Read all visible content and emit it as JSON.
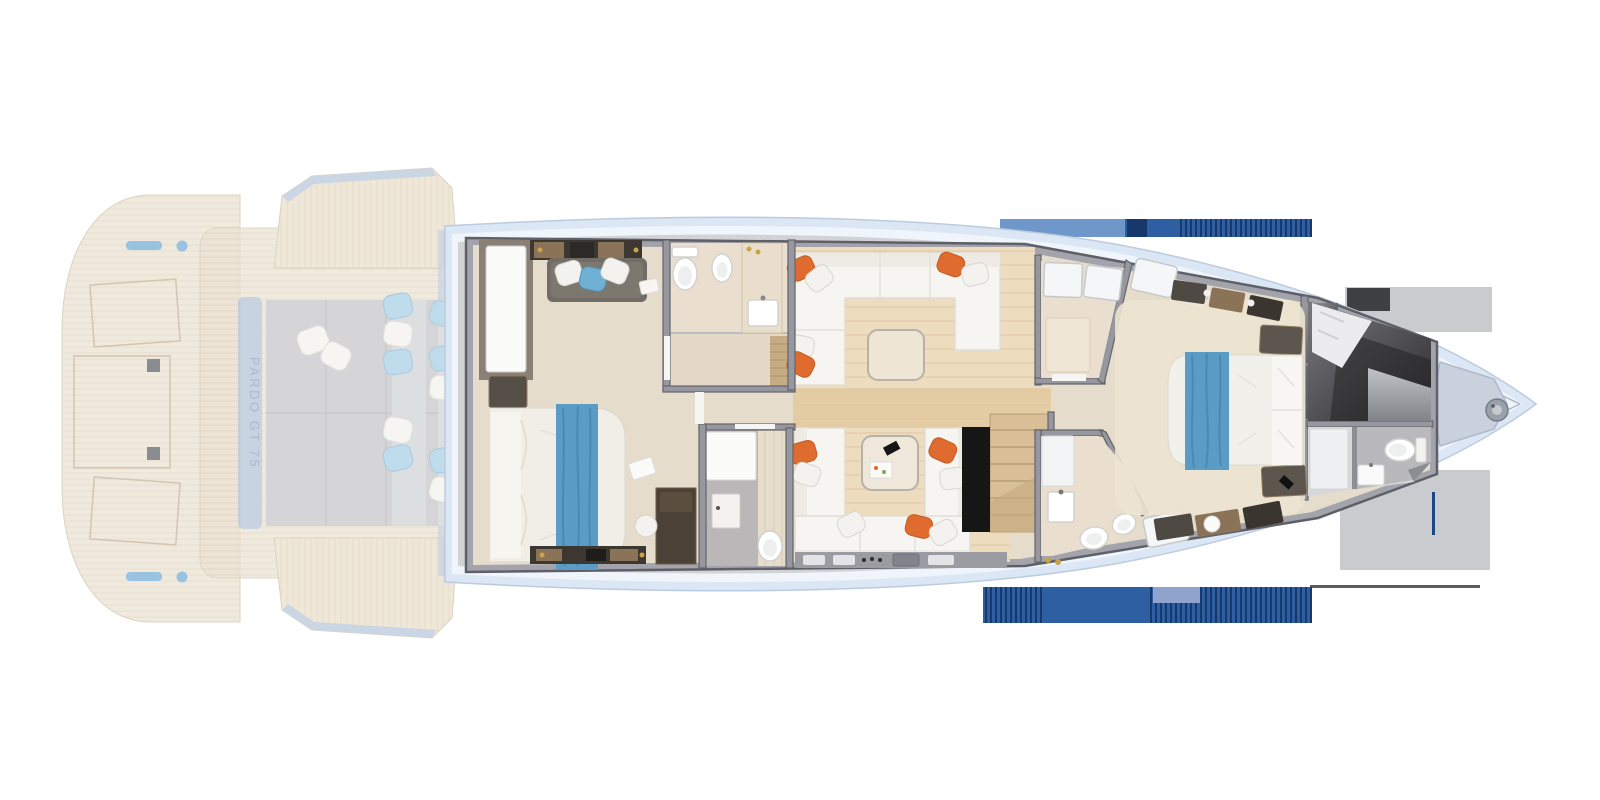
{
  "branding": {
    "model_label": "PARDO GT 75"
  },
  "palette": {
    "page_bg": "#ffffff",
    "teak": "#ede5d6",
    "teak_line": "#d8c9ae",
    "hull_band": "#dce7f5",
    "hull_band_inner": "#f0f5fc",
    "deck_gray": "#d2d3d7",
    "wall_gray": "#a3a4ab",
    "wall_stroke": "#5f6067",
    "floor_beige": "#e6dccb",
    "wood_floor": "#eddcbe",
    "corridor_wood": "#e4cda4",
    "sofa_white": "#f6f5f1",
    "pillow_orange": "#df6c2e",
    "pillow_blue": "#a9d1e6",
    "throw_blue": "#5b9cc6",
    "furniture_dark": "#4e4a45",
    "stair_black": "#161616",
    "navy_bar": "#2e5fa3",
    "navy_dark": "#16386b",
    "bow_deck": "#c9d1dd",
    "transom_band": "#b6c5d8",
    "label_blue": "#8fa2bb"
  },
  "fixtures": [
    "swim-platform",
    "stern-cleats",
    "deck-hatches",
    "fold-out-terrace-port",
    "fold-out-terrace-starboard",
    "aft-sunpad-with-cushions",
    "transom-model-label",
    "master-cabin-bed",
    "master-cabin-sofa",
    "master-wardrobe",
    "master-bathroom-toilet",
    "master-bathroom-bidet",
    "master-bathroom-washbasin",
    "master-shower",
    "day-head-washbasin",
    "day-head-toilet",
    "salon-l-sofa",
    "salon-table",
    "dinette-sofas",
    "coffee-table",
    "galley-counter",
    "staircase",
    "vip-shower-room",
    "vip-bathroom-washbasin",
    "vip-bathroom-toilet",
    "vip-bathroom-bidet",
    "vip-bed",
    "nightstands",
    "bow-cabin-bed",
    "bow-bathroom-toilet",
    "bow-bathroom-washbasin",
    "anchor-windlass",
    "bow-sunpad"
  ]
}
